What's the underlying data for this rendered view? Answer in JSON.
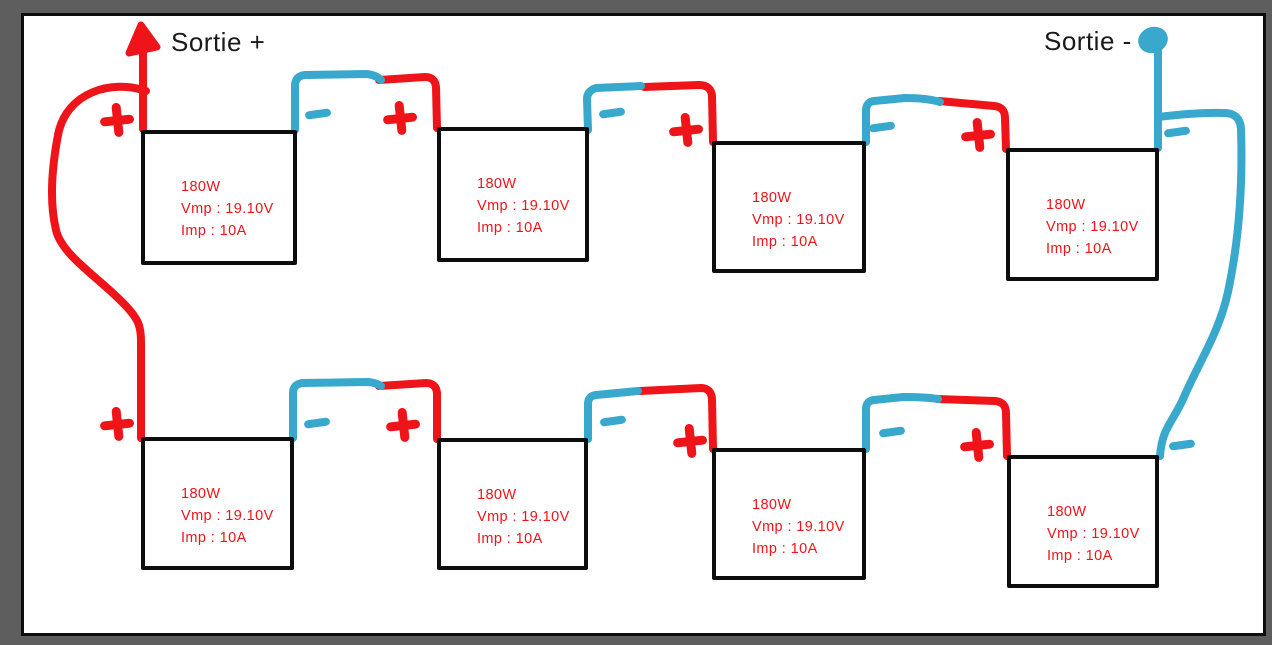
{
  "labels": {
    "output_positive": "Sortie +",
    "output_negative": "Sortie -"
  },
  "panels": [
    {
      "id": "top-1",
      "power": "180W",
      "vmp": "Vmp : 19.10V",
      "imp": "Imp : 10A"
    },
    {
      "id": "top-2",
      "power": "180W",
      "vmp": "Vmp : 19.10V",
      "imp": "Imp : 10A"
    },
    {
      "id": "top-3",
      "power": "180W",
      "vmp": "Vmp : 19.10V",
      "imp": "Imp : 10A"
    },
    {
      "id": "top-4",
      "power": "180W",
      "vmp": "Vmp : 19.10V",
      "imp": "Imp : 10A"
    },
    {
      "id": "bottom-1",
      "power": "180W",
      "vmp": "Vmp : 19.10V",
      "imp": "Imp : 10A"
    },
    {
      "id": "bottom-2",
      "power": "180W",
      "vmp": "Vmp : 19.10V",
      "imp": "Imp : 10A"
    },
    {
      "id": "bottom-3",
      "power": "180W",
      "vmp": "Vmp : 19.10V",
      "imp": "Imp : 10A"
    },
    {
      "id": "bottom-4",
      "power": "180W",
      "vmp": "Vmp : 19.10V",
      "imp": "Imp : 10A"
    }
  ],
  "terminals": {
    "positive_symbol": "+",
    "negative_symbol": "-"
  },
  "icons": {
    "positive_terminal": "plus-icon",
    "negative_terminal": "minus-icon",
    "output_positive_marker": "arrow-up-icon",
    "output_negative_marker": "dot-blob-icon"
  },
  "colors": {
    "positive": "#ee1419",
    "negative": "#38a8cd",
    "frame": "#5e5e5e",
    "canvas": "#ffffff",
    "ink": "#0d0d0d",
    "label-text": "#1a1a1a"
  }
}
